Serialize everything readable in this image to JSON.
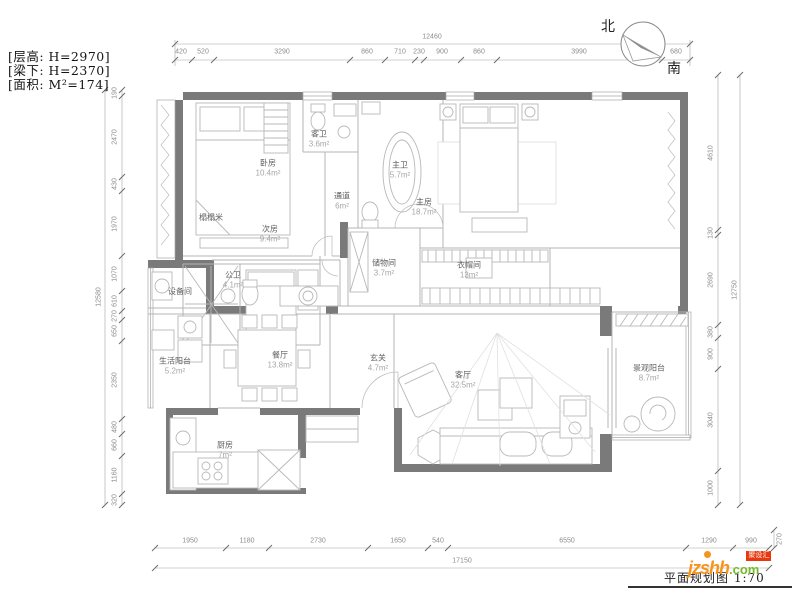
{
  "info_notes": {
    "line1": "[层高: H=2970]",
    "line2": "[梁下: H=2370]",
    "line3": "[面积: M²=174]"
  },
  "compass": {
    "north_label": "北",
    "south_label": "南"
  },
  "rooms": [
    {
      "name": "卧房",
      "area": "10.4m²"
    },
    {
      "name": "客卫",
      "area": "3.6m²"
    },
    {
      "name": "主卫",
      "area": "5.7m²"
    },
    {
      "name": "主房",
      "area": "18.7m²"
    },
    {
      "name": "通道",
      "area": "6m²"
    },
    {
      "name": "次房",
      "area": "9.4m²"
    },
    {
      "name": "榻榻米",
      "area": ""
    },
    {
      "name": "储物间",
      "area": "3.7m²"
    },
    {
      "name": "衣帽间",
      "area": "13m²"
    },
    {
      "name": "设备间",
      "area": ""
    },
    {
      "name": "公卫",
      "area": "4.1m²"
    },
    {
      "name": "生活阳台",
      "area": "5.2m²"
    },
    {
      "name": "餐厅",
      "area": "13.8m²"
    },
    {
      "name": "玄关",
      "area": "4.7m²"
    },
    {
      "name": "客厅",
      "area": "32.5m²"
    },
    {
      "name": "厨房",
      "area": "7m²"
    },
    {
      "name": "景观阳台",
      "area": "8.7m²"
    }
  ],
  "dimensions": {
    "top": {
      "total": "12460",
      "segments": [
        "420",
        "520",
        "3290",
        "860",
        "710",
        "230",
        "900",
        "860",
        "3990",
        "680"
      ]
    },
    "left": {
      "total": "12580",
      "segments": [
        "190",
        "2470",
        "430",
        "1970",
        "1070",
        "610",
        "270",
        "650",
        "2350",
        "480",
        "660",
        "1160",
        "320"
      ]
    },
    "right": {
      "total": "12750",
      "segments": [
        "4610",
        "130",
        "2690",
        "380",
        "900",
        "3040",
        "1000"
      ]
    },
    "bottom": {
      "total": "17150",
      "segments": [
        "1950",
        "1180",
        "2730",
        "1650",
        "540",
        "6550",
        "1290",
        "990"
      ],
      "side": "270"
    }
  },
  "footer": {
    "title": "平面规划图 1:70",
    "watermark_text": "jzshh",
    "watermark_suffix": ".com",
    "watermark_badge": "聚设汇"
  },
  "colors": {
    "wall": "#7a7a7a",
    "thin_line": "#b4b4b4",
    "dim_line": "#a3a3a3",
    "accent_orange": "#f7941d",
    "accent_green": "#76b82a",
    "accent_red": "#e8380d"
  }
}
